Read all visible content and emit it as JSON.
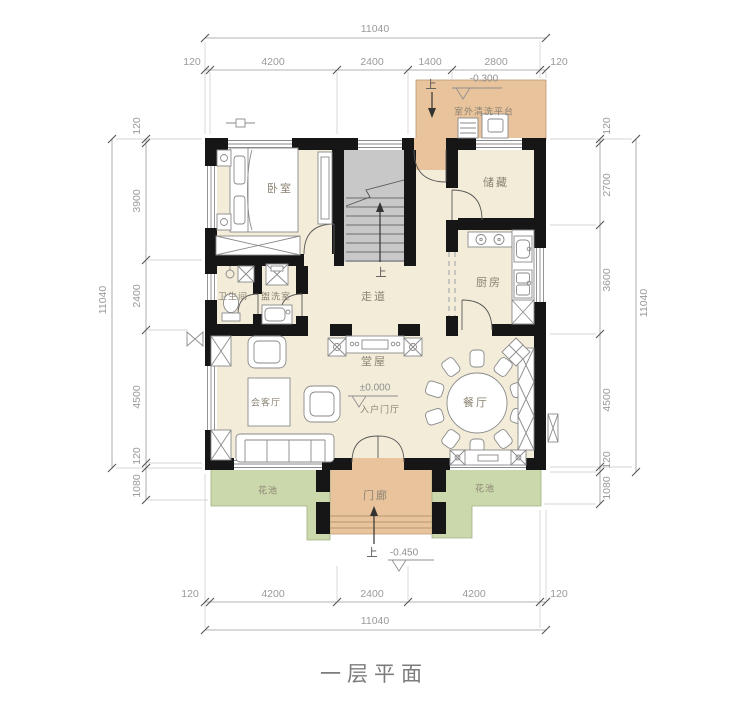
{
  "title": "一层平面",
  "rooms": {
    "bedroom": "卧室",
    "storage": "储藏",
    "kitchen": "厨房",
    "bathroom": "卫生间",
    "washroom": "盥洗室",
    "corridor": "走道",
    "hall": "堂屋",
    "living": "会客厅",
    "dining": "餐厅",
    "porch": "门廊",
    "flower": "花池",
    "platform": "室外清洗平台",
    "foyer": "入户门厅"
  },
  "marks": {
    "up": "上",
    "elev_platform": "-0.300",
    "elev_foyer": "±0.000",
    "elev_porch": "-0.450"
  },
  "dims": {
    "top": {
      "total": "11040",
      "segs": [
        "120",
        "4200",
        "2400",
        "1400",
        "2800",
        "120"
      ]
    },
    "bottom": {
      "total": "11040",
      "segs": [
        "120",
        "4200",
        "2400",
        "4200",
        "120"
      ]
    },
    "left": {
      "total": "11040",
      "segs": [
        "120",
        "3900",
        "2400",
        "4500",
        "120",
        "1080"
      ]
    },
    "right": {
      "total": "11040",
      "segs": [
        "120",
        "2700",
        "3600",
        "4500",
        "120",
        "1080"
      ]
    }
  },
  "colors": {
    "wall": "#161616",
    "floor": "#f2ecd9",
    "porch_tan": "#e9c39b",
    "garden_green": "#cbd8ac",
    "stair_gray": "#c8c8c8",
    "dim_gray": "#9a9a9a"
  }
}
